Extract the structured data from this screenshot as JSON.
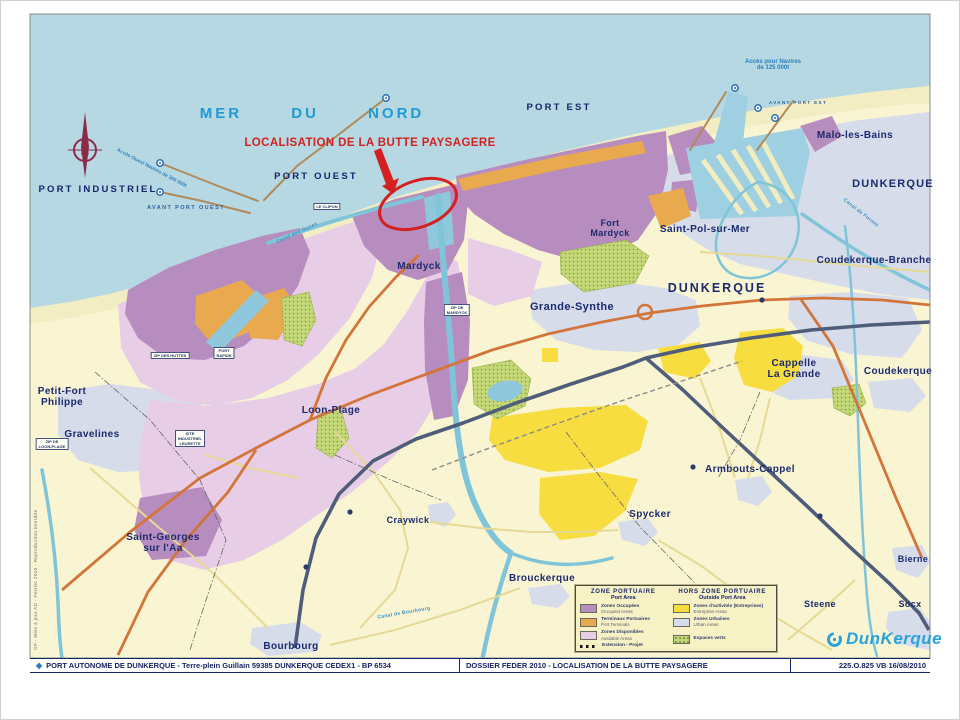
{
  "colors": {
    "sea": "#b6d8e2",
    "sand": "#f3edc3",
    "land": "#f9f5d2",
    "urban": "#d6dcea",
    "zone_occupied": "#b78cbe",
    "zone_terminal": "#e9a94f",
    "zone_available": "#e8cde6",
    "zone_activity": "#f7dd40",
    "zone_green": "#c5d878",
    "canal": "#7fc4d8",
    "road_main": "#d2753a",
    "motorway": "#4f5d7a",
    "annotation_red": "#d42020",
    "sea_text": "#1f9ad2",
    "town_text": "#1b2a6e",
    "logo_blue": "#2aa3da"
  },
  "sea": {
    "name": "MER DU NORD"
  },
  "annotation": {
    "label": "LOCALISATION DE LA BUTTE PAYSAGERE"
  },
  "compass": {
    "letter": "N"
  },
  "ports": {
    "industriel": "PORT INDUSTRIEL",
    "ouest": "PORT OUEST",
    "est": "PORT EST",
    "avant_ouest": "AVANT PORT OUEST",
    "avant_est": "AVANT PORT EST"
  },
  "access": {
    "east": "Accès pour Navires\nde 125 000t",
    "west": "Accès Ouest Navires de 300 000t"
  },
  "towns": {
    "malo": "Malo-les-Bains",
    "dunkerque_ne": "DUNKERQUE",
    "saint_pol": "Saint-Pol-sur-Mer",
    "coudekerque_branche": "Coudekerque-Branche",
    "fort_mardyck": "Fort\nMardyck",
    "mardyck": "Mardyck",
    "dunkerque": "DUNKERQUE",
    "grande_synthe": "Grande-Synthe",
    "cappelle": "Cappelle\nLa Grande",
    "coudekerque": "Coudekerque",
    "loon_plage": "Loon-Plage",
    "petit_fort": "Petit-Fort\nPhilippe",
    "gravelines": "Gravelines",
    "saint_georges": "Saint-Georges\nsur l'Aa",
    "craywick": "Craywick",
    "spycker": "Spycker",
    "armbouts": "Armbouts-Cappel",
    "brouckerque": "Brouckerque",
    "bourbourg": "Bourbourg",
    "steene": "Steene",
    "bierne": "Bierne",
    "socx": "Socx"
  },
  "sites": {
    "clipon": "LE CLIPON",
    "zip_huttes": "ZIP DES HUTTES",
    "port_rapide": "PORT\nRAPIDE",
    "site_leurette": "SITE\nINDUSTRIEL\nLEURETTE",
    "zip_loon": "ZIP DE\nLOON-PLAGE",
    "zip_mardyck": "ZIP DE\nMARDYCK"
  },
  "waterways": {
    "dunes": "Canal des Dunes",
    "bourbourg": "Canal de Bourbourg",
    "furnes": "Canal de Furnes"
  },
  "legend": {
    "port": {
      "title": "ZONE PORTUAIRE",
      "subtitle": "Port Area",
      "items": [
        {
          "fr": "Zones Occupées",
          "en": "Occupied Areas",
          "color": "#b78cbe"
        },
        {
          "fr": "Terminaux Portuaires",
          "en": "Port Terminals",
          "color": "#e9a94f"
        },
        {
          "fr": "Zones Disponibles",
          "en": "Available Areas",
          "color": "#e8cde6"
        },
        {
          "fr": "Extension - Projet",
          "en": "",
          "color": ""
        }
      ]
    },
    "outside": {
      "title": "HORS ZONE  PORTUAIRE",
      "subtitle": "Outside Port Area",
      "items": [
        {
          "fr": "Zones d'activités (Entreprises)",
          "en": "Entreprise Areas",
          "color": "#f7dd40"
        },
        {
          "fr": "Zones Urbaines",
          "en": "Urban Areas",
          "color": "#d6dcea"
        },
        {
          "fr": "Espaces verts",
          "en": "",
          "color": "#c5d878"
        }
      ]
    }
  },
  "footer": {
    "company": "PORT AUTONOME DE DUNKERQUE - Terre-plein Guillain  59385 DUNKERQUE CEDEX1 -  BP 6534",
    "dossier": "DOSSIER FEDER 2010 - LOCALISATION DE LA BUTTE PAYSAGERE",
    "ref": "225.O.825  VB  16/08/2010"
  },
  "logo": {
    "name": "DunKerque"
  },
  "credits": "GP - Mise à jour AD - Février 2010 - Reproduction interdite"
}
